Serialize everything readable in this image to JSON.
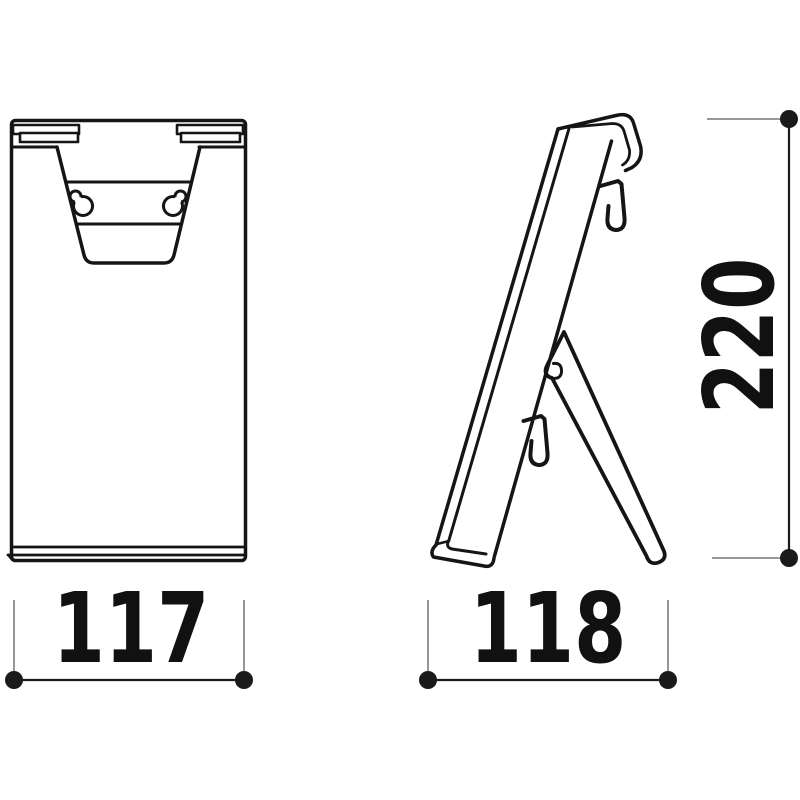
{
  "drawing": {
    "dimensions": {
      "front_width": {
        "value": "117",
        "orientation": "horizontal"
      },
      "side_depth": {
        "value": "118",
        "orientation": "horizontal"
      },
      "side_height": {
        "value": "220",
        "orientation": "vertical"
      }
    },
    "colors": {
      "line": "#151515",
      "dimension_line": "#1a1a1a",
      "extension_line": "#8a8a8a",
      "background": "#ffffff"
    }
  }
}
